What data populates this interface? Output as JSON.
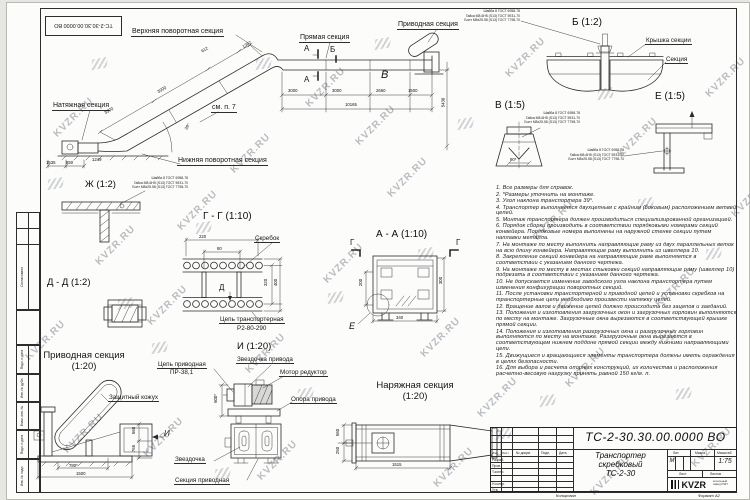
{
  "watermark": "KVZR.RU",
  "corner_stamp": "ТС-2-30.30.00.0000 ВО",
  "frame": {
    "agreed": "Согласовано",
    "strip": [
      "Подп. и дата",
      "Инв. № дубл.",
      "Взам. инв. №",
      "Подп. и дата",
      "Инв. № подл."
    ]
  },
  "fasteners": {
    "l1": "Шайба 8 ГОСТ 6958-78",
    "l2": "Гайка М8-6Н5 (S13) ГОСТ 5931-70",
    "l3": "Болт М8х25.58 (S13) ГОСТ 7798-70"
  },
  "general": {
    "upper_turn": "Верхняя поворотная секция",
    "straight": "Прямая секция",
    "drive": "Приводная секция",
    "tension": "Натяжная секция",
    "lower_turn": "Нижняя поворотная секция",
    "see_p7": "см. п. 7",
    "mark_a": "А",
    "mark_b": "Б",
    "mark_v": "В",
    "dims": {
      "d1": "1535",
      "d2": "850",
      "d3": "1249",
      "i1": "3000",
      "i2": "3000",
      "i3": "612",
      "i4": "1367",
      "t1": "3000",
      "t2": "3000",
      "t3": "2660",
      "t4": "1500",
      "total": "10165",
      "height": "5430",
      "angle": "39°"
    }
  },
  "view_zh": {
    "title": "Ж (1:2)"
  },
  "view_dd": {
    "title": "Д - Д (1:2)"
  },
  "view_gg": {
    "title": "Г - Г (1:10)",
    "scraper": "Скребок",
    "chain_l1": "Цепь транспортерная",
    "chain_l2": "Р2-80-290",
    "mark_d": "Д",
    "dims": {
      "w": "220",
      "w2": "80",
      "h1": "320",
      "h2": "400"
    }
  },
  "view_aa": {
    "title": "А - А (1:10)",
    "mark_g": "Г",
    "mark_e": "Е",
    "dims": {
      "left": "200",
      "right": "300",
      "bottom": "340"
    }
  },
  "view_b": {
    "title": "Б (1:2)",
    "cover": "Крышка секции",
    "section": "Секция"
  },
  "view_v": {
    "title": "В (1:5)",
    "dim": "90*"
  },
  "view_e": {
    "title": "Е (1:5)"
  },
  "view_drive": {
    "title": "Приводная секция",
    "scale": "(1:20)",
    "casing": "Защитный кожух",
    "mark_i": "И",
    "dims": {
      "w1": "780*",
      "w2": "1500",
      "h1": "560",
      "h2": "765"
    }
  },
  "view_i": {
    "title": "И (1:20)",
    "chain_l1": "Цепь приводная",
    "chain_l2": "ПР-38,1",
    "drive_sprocket": "Звездочка привода",
    "motor": "Мотор редуктор",
    "support": "Опора привода",
    "sprocket": "Звездочка",
    "section": "Секция приводная",
    "dim_h": "600*"
  },
  "view_tension": {
    "title": "Наряжная секция",
    "scale": "(1:20)",
    "dims": {
      "len": "1515",
      "h1": "560",
      "h2": "250"
    }
  },
  "notes": {
    "items": [
      "1. Все размеры для справок.",
      "2. *Размеры уточнить на монтаже.",
      "3. Угол наклона транспортера 39°.",
      "4. Транспортер выполняется двухцепным с крайним (боковым) расположением ветвей цепей.",
      "5. Монтаж транспортера должен производиться специализированной организацией.",
      "6. Порядок сборки производить в соответствии порядковыми номерами секций конвейера. Порядковые номера выполнены на наружной стенке секции путем наплавки металла.",
      "7. На монтаже по месту выполнить направляющие раму из двух параллельных веток на всю длину конвейера. Направляющие раму выполнить из швеллера 10.",
      "8. Закрепление секций конвейера на направляющие раме выполняется в соответствии с указанием данного чертежа.",
      "9. На монтаже по месту в местах стыковки секций направляющие раму (швеллер 10) подрезать в соответствии с указанием данного чертежа.",
      "10. Не допускается изменение заводского угла наклона транспортера путем изменения конфигурации поворотных секций.",
      "11. После установки транспортерной и приводной цепей и установки скребков на транспортерные цепи необходимо произвести натяжку цепей.",
      "12. Вращение валов и движение цепей должно происходить без зацепов и заеданий.",
      "13. Положения и изготовления загрузочных окон и загрузочных горловин выполняются по месту на монтаже. Загрузочные окна вырезаются в соответствующей крышке прямой секции.",
      "14. Положения и изготовления разгрузочных окна и разгрузочных горловин выполняются по месту на монтаже. Разгрузочные окна вырезаются в соответствующем нижнем поддоне прямой секции между нижними направляющими цепи.",
      "15. Движущиеся и вращающиеся элементы транспортера должны иметь ограждения в целях безопасности.",
      "16. Для выбора и расчета опорных конструкций, их количества и расположения расчетно-весовую нагрузку принять равной 150 кг/м. п."
    ]
  },
  "titleblock": {
    "doc_number": "ТС-2-30.30.00.0000 ВО",
    "name_l1": "Транспортер",
    "name_l2": "скребковый",
    "name_l3": "ТС-2-30",
    "lit_header": "Лит.",
    "mass_header": "Масса",
    "scale_header": "Масштаб",
    "lit": "М",
    "scale": "1:75",
    "sheet": "Лист",
    "sheets": "Листов",
    "rows": {
      "izm": "Изм.",
      "list": "Лист",
      "doc": "№ докум.",
      "podp": "Подп.",
      "data": "Дата",
      "razrab": "Разраб.",
      "prov": "Пров.",
      "tkontr": "Т.контр.",
      "nkontr": "Н.контр.",
      "utv": "Утв."
    },
    "logo": "KVZR",
    "logo_sub1": "котельный",
    "logo_sub2": "завод РЭП",
    "copied": "Копировал",
    "format": "Формат А2"
  }
}
